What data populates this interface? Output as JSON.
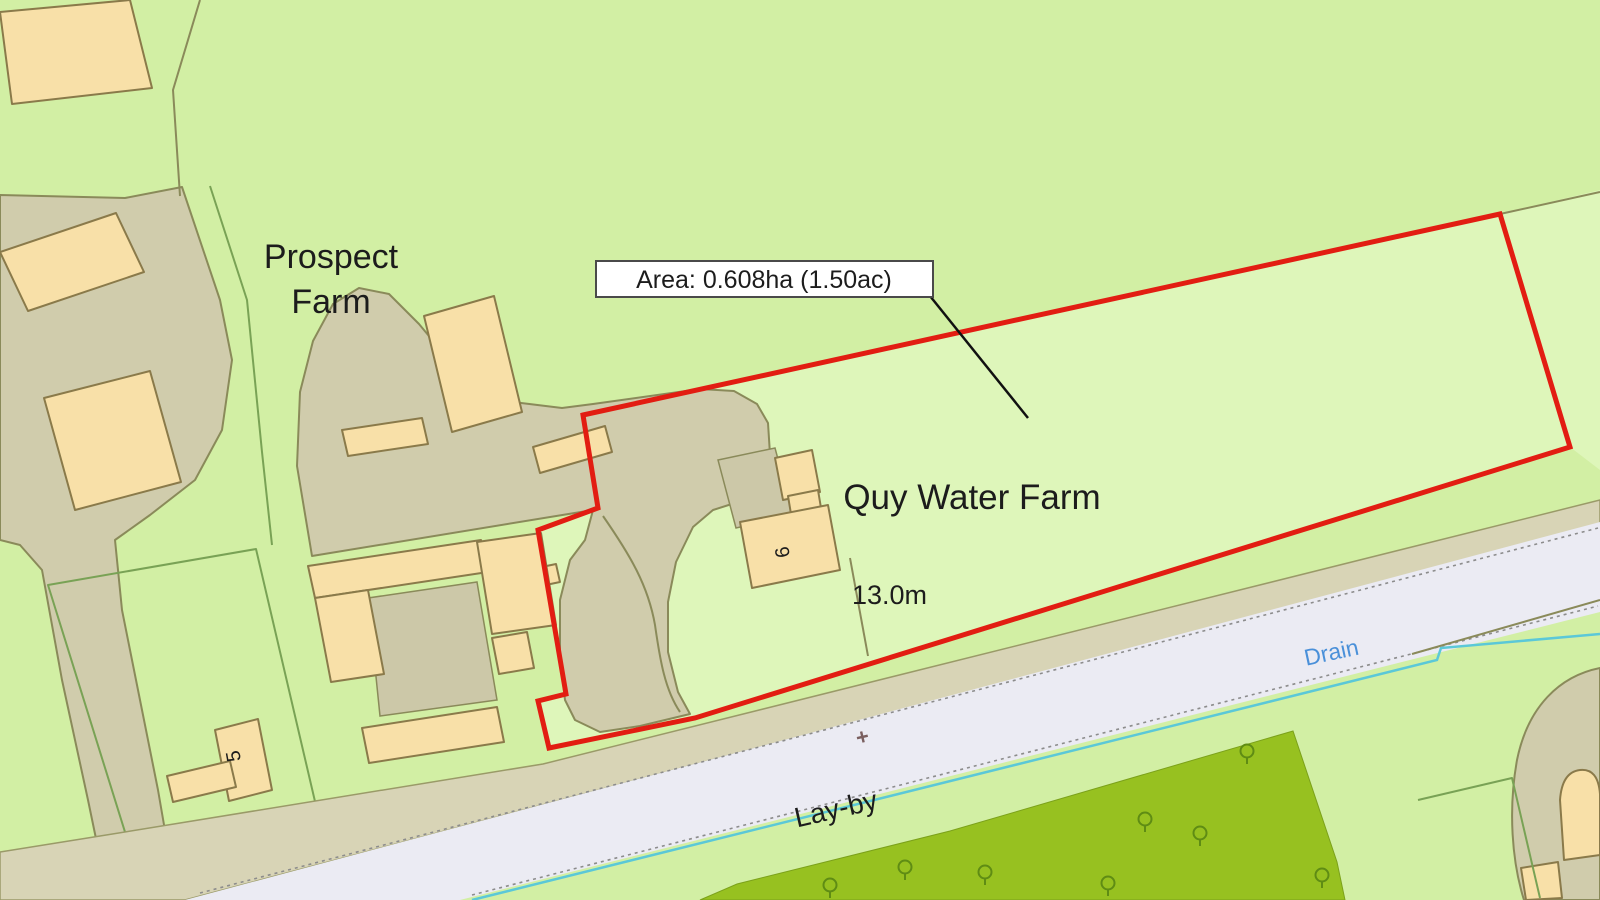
{
  "map": {
    "labels": {
      "prospect_line1": "Prospect",
      "prospect_line2": "Farm",
      "quy_water_farm": "Quy Water Farm",
      "dimension_13m": "13.0m",
      "area_box": "Area: 0.608ha (1.50ac)",
      "layby": "Lay-by",
      "drain": "Drain",
      "building_no_6": "6",
      "building_no_5": "5",
      "bench_mark": "+"
    },
    "site": {
      "area_hectares": "0.608ha",
      "area_acres": "1.50ac",
      "frontage_dimension": "13.0m"
    },
    "colors": {
      "field_green": "#d2efa4",
      "field_light_green": "#def6ba",
      "farmyard_grey": "#d0ccac",
      "building_tan": "#f8e0a8",
      "building_outline": "#8a7a4a",
      "road_grey": "#ebebf3",
      "road_edge_grey": "#8c8c8c",
      "verge_tan": "#d8d4b6",
      "boundary_red": "#e21d12",
      "drain_cyan": "#5bc8d8",
      "drain_text_blue": "#4a90d9",
      "orchard_green": "#97c120",
      "tree_outline": "#5f8c14",
      "olive_line": "#8a8a5a",
      "plot_line_green": "#79a255",
      "text_black": "#1c1c1c"
    }
  }
}
